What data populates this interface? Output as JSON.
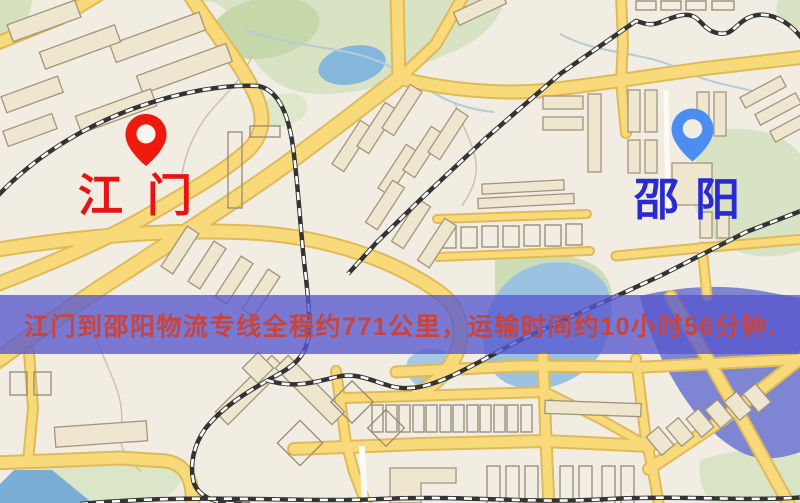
{
  "map": {
    "origin": {
      "label": "江门",
      "pin_color": "#ee1a10",
      "label_color": "#e81414"
    },
    "destination": {
      "label": "邵阳",
      "pin_color": "#4b8df0",
      "label_color": "#2a2ad4"
    }
  },
  "banner": {
    "text": "江门到邵阳物流专线全程约771公里，运输时间约10小时56分钟.",
    "distance_km": "771",
    "duration_hours": "10",
    "duration_minutes": "56",
    "bg_color": "#5757ce",
    "text_color": "#c8443c"
  },
  "map_colors": {
    "background": "#f2ede2",
    "road": "#f8da7a",
    "building": "#efe6d0",
    "park": "#d7e3c2",
    "water": "#92bede",
    "river": "#7e85d2",
    "railway": "#333333"
  }
}
